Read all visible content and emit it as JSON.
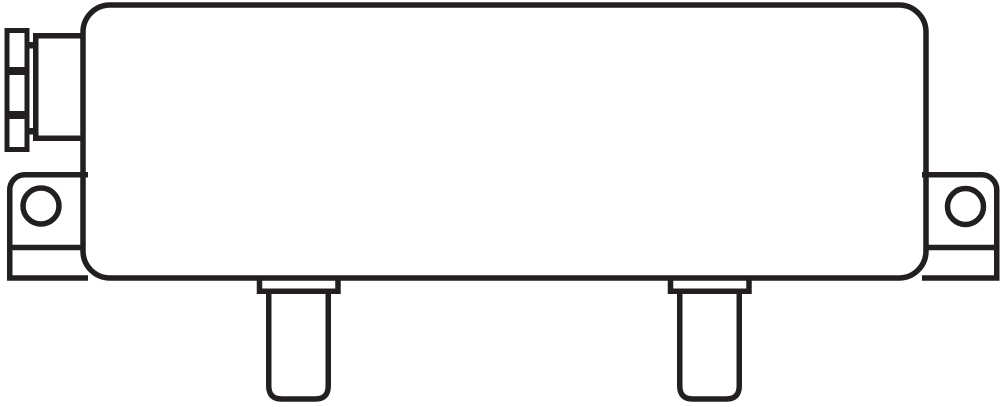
{
  "canvas": {
    "width": 1000,
    "height": 407,
    "background": "#ffffff"
  },
  "drawing": {
    "stroke": "#231f20",
    "fill": "#ffffff",
    "stroke_width_main": 5.5,
    "stroke_width_thin": 5
  },
  "figure": {
    "kind": "technical-line-drawing",
    "view": "side-elevation",
    "description": "Rounded rectangular enclosure body with a segmented panel-mount connector on the left side, left and right mounting tabs each with a round hole, and two rounded-bottom mounting legs with collars extending below the base line.",
    "components": [
      "panel-connector-flange",
      "connector-screw-top",
      "connector-screw-bottom",
      "connector-housing",
      "enclosure-body",
      "mounting-tab-left",
      "mounting-hole-left",
      "mounting-tab-right",
      "mounting-hole-right",
      "leg-left",
      "leg-right"
    ]
  }
}
